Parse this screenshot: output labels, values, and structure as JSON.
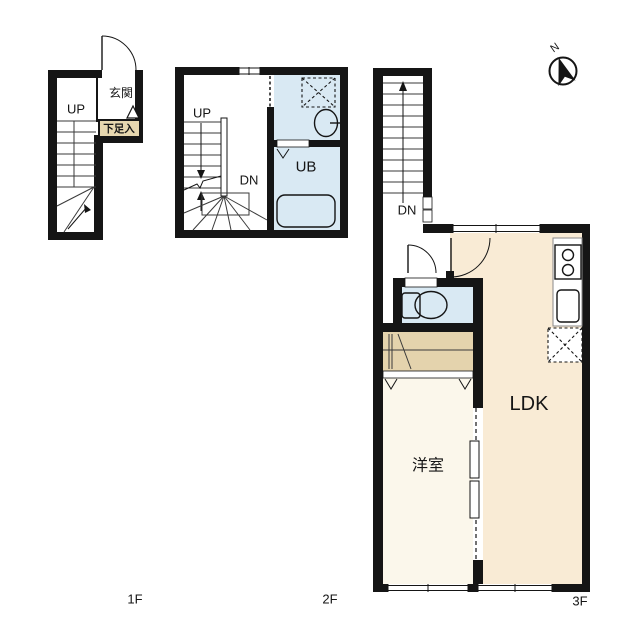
{
  "title": "apartment-floor-plan",
  "colors": {
    "wall": "#151515",
    "water_room": "#d9e9f3",
    "ldk": "#f9ebd5",
    "bedroom": "#fbf7eb",
    "closet": "#e4d3ad",
    "shoe_box": "#e7d7af",
    "white": "#ffffff"
  },
  "floor1": {
    "label": "1F",
    "up": "UP",
    "entrance": "玄関",
    "shoe_box": "下足入"
  },
  "floor2": {
    "label": "2F",
    "up": "UP",
    "down": "DN",
    "unit_bath": "UB"
  },
  "floor3": {
    "label": "3F",
    "down": "DN",
    "living": "LDK",
    "bedroom": "洋室"
  },
  "compass": {
    "north": "N"
  }
}
